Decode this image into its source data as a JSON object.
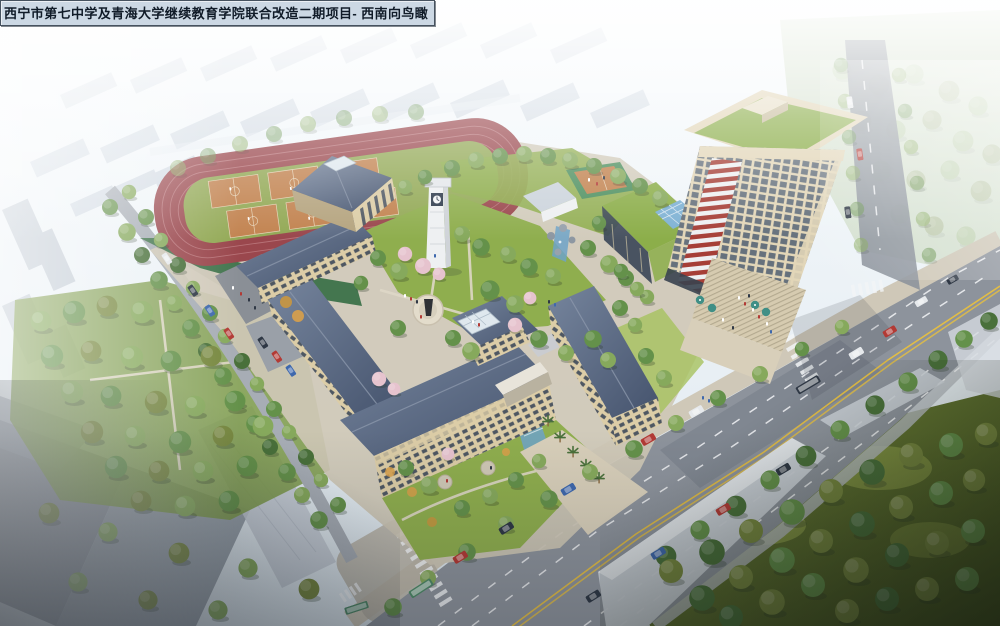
{
  "title_bar": {
    "label": "西宁市第七中学及青海大学继续教育学院联合改造二期项目- 西南向鸟瞰"
  },
  "colors": {
    "sky": "#f3f8fb",
    "haze": "#d9e3ec",
    "city_far": "#bec9d6",
    "city_side": "#a7b1be",
    "city_dark": "#707785",
    "park_far": "#a9bf8c",
    "lawn": "#8fae4e",
    "lawn_bright": "#a6c25e",
    "bank_green": "#44764f",
    "tree_dark": "#49703a",
    "tree_mid": "#64914a",
    "tree_light": "#86a95c",
    "tree_olive": "#77883f",
    "blossom": "#e6c3ce",
    "track": "#9a474d",
    "track_lane": "#c07f84",
    "infield": "#93a956",
    "court": "#c28350",
    "court_line": "#ead9bf",
    "roof_hi": "#74839b",
    "roof_lo": "#46546e",
    "facade": "#dccda7",
    "facade_shade": "#b5a47f",
    "window": "#3a4659",
    "white_wall": "#eef0f2",
    "tower_cream": "#e2d6b8",
    "tower_glass": "#5b6878",
    "tower_red": "#a63f37",
    "green_roof": "#8cae4a",
    "glass_blue": "#7fb2d4",
    "road": "#8d939c",
    "road_light": "#a7adb5",
    "sidewalk": "#cfc8b8",
    "plaza": "#d8cfba",
    "line_yellow": "#e2bd45",
    "line_white": "#f3f5f7",
    "water": "#6fa3c8",
    "umbrella": "#3f8f86",
    "car_red": "#b23a35",
    "car_blue": "#3e68ad",
    "car_dark": "#2f3845",
    "car_white": "#e6e9ec",
    "bus_green": "#4f8a68",
    "statue_dark": "#2e3136",
    "title_bg": "#ccd8e4",
    "title_border": "#46525f",
    "title_text": "#101b28"
  }
}
